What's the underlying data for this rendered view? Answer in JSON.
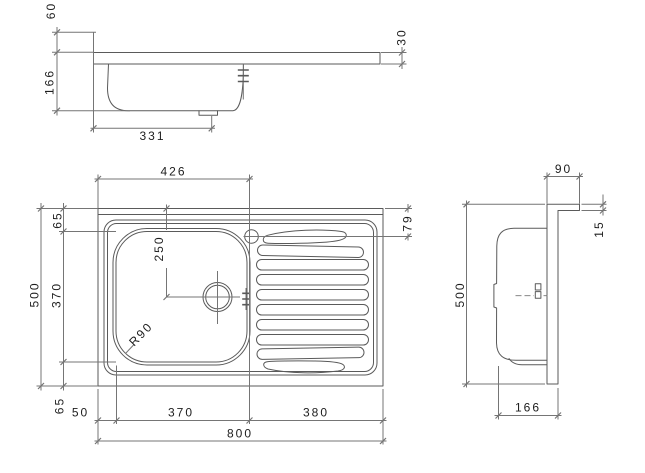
{
  "drawing": {
    "colors": {
      "background": "#ffffff",
      "geometry_lines": "#5a5a5a",
      "dimension_lines": "#757575",
      "label_text": "#1d1d1d"
    },
    "views": {
      "side": {
        "dims": {
          "upstand_height": "60",
          "rim_thickness": "30",
          "bowl_depth": "166",
          "drain_offset": "331"
        }
      },
      "plan": {
        "dims": {
          "tap_hole_offset_x": "426",
          "rim_margin_top": "65",
          "tap_hole_offset_y": "79",
          "drain_offset_y": "250",
          "overall_depth": "500",
          "bowl_length": "370",
          "bowl_corner_radius": "R90",
          "rim_margin_bottom": "65",
          "rim_margin_left": "50",
          "bowl_width": "370",
          "drainer_width": "380",
          "overall_width": "800"
        }
      },
      "end": {
        "dims": {
          "flange_width": "90",
          "edge_height": "15",
          "overall_depth": "500",
          "bowl_section_width": "166"
        }
      }
    }
  }
}
